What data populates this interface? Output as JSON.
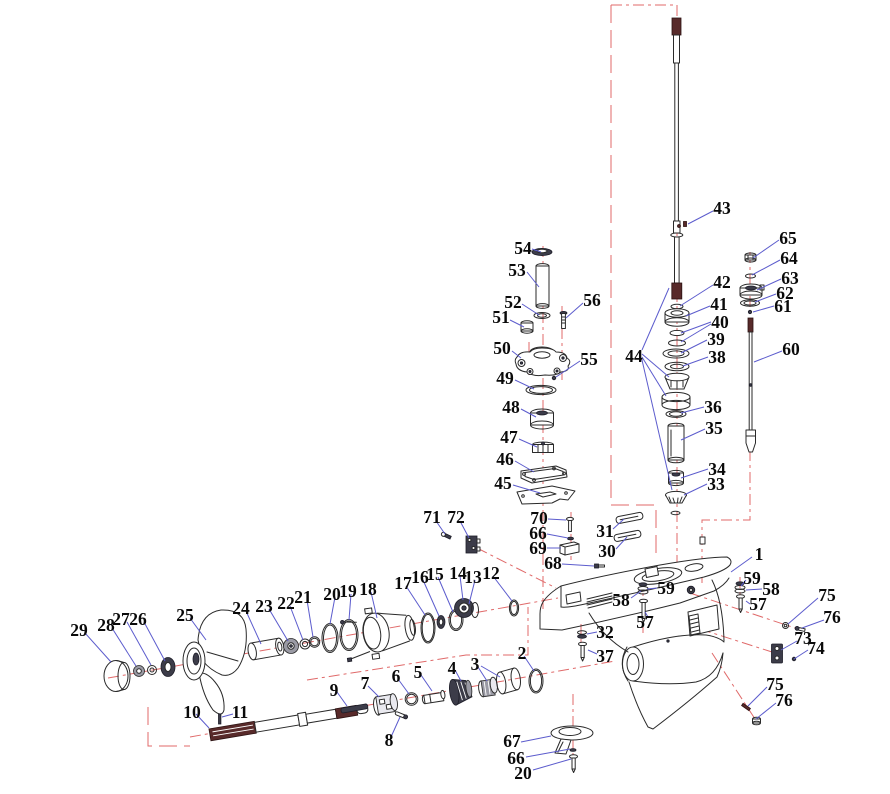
{
  "diagram": {
    "type": "exploded-parts-diagram",
    "subject": "Outboard motor lower unit gearcase exploded view",
    "colors": {
      "background": "#ffffff",
      "outline": "#2a2a2a",
      "leader_line": "#5c5ccd",
      "centerline": "#e06a6a",
      "label_text": "#0a0a0a",
      "dark_part": "#3c3c49",
      "spline_maroon": "#582a2a"
    },
    "labels": [
      {
        "t": "54",
        "x": 523,
        "y": 248
      },
      {
        "t": "53",
        "x": 517,
        "y": 270
      },
      {
        "t": "52",
        "x": 513,
        "y": 302
      },
      {
        "t": "56",
        "x": 592,
        "y": 300
      },
      {
        "t": "51",
        "x": 501,
        "y": 317
      },
      {
        "t": "50",
        "x": 502,
        "y": 348
      },
      {
        "t": "55",
        "x": 589,
        "y": 359
      },
      {
        "t": "49",
        "x": 505,
        "y": 378
      },
      {
        "t": "48",
        "x": 511,
        "y": 407
      },
      {
        "t": "47",
        "x": 509,
        "y": 437
      },
      {
        "t": "46",
        "x": 505,
        "y": 459
      },
      {
        "t": "45",
        "x": 503,
        "y": 483
      },
      {
        "t": "43",
        "x": 722,
        "y": 208
      },
      {
        "t": "42",
        "x": 722,
        "y": 282
      },
      {
        "t": "41",
        "x": 719,
        "y": 304
      },
      {
        "t": "40",
        "x": 720,
        "y": 322
      },
      {
        "t": "39",
        "x": 716,
        "y": 339
      },
      {
        "t": "38",
        "x": 717,
        "y": 357
      },
      {
        "t": "44",
        "x": 634,
        "y": 356
      },
      {
        "t": "36",
        "x": 713,
        "y": 407
      },
      {
        "t": "35",
        "x": 714,
        "y": 428
      },
      {
        "t": "34",
        "x": 717,
        "y": 469
      },
      {
        "t": "33",
        "x": 716,
        "y": 484
      },
      {
        "t": "65",
        "x": 788,
        "y": 238
      },
      {
        "t": "64",
        "x": 789,
        "y": 258
      },
      {
        "t": "63",
        "x": 790,
        "y": 278
      },
      {
        "t": "62",
        "x": 785,
        "y": 293
      },
      {
        "t": "61",
        "x": 783,
        "y": 306
      },
      {
        "t": "60",
        "x": 791,
        "y": 349
      },
      {
        "t": "1",
        "x": 759,
        "y": 554
      },
      {
        "t": "59",
        "x": 666,
        "y": 588
      },
      {
        "t": "58",
        "x": 621,
        "y": 600
      },
      {
        "t": "57",
        "x": 645,
        "y": 622
      },
      {
        "t": "59",
        "x": 752,
        "y": 578
      },
      {
        "t": "58",
        "x": 771,
        "y": 589
      },
      {
        "t": "57",
        "x": 758,
        "y": 604
      },
      {
        "t": "32",
        "x": 605,
        "y": 632
      },
      {
        "t": "37",
        "x": 605,
        "y": 656
      },
      {
        "t": "68",
        "x": 553,
        "y": 563
      },
      {
        "t": "70",
        "x": 539,
        "y": 518
      },
      {
        "t": "66",
        "x": 538,
        "y": 533
      },
      {
        "t": "69",
        "x": 538,
        "y": 548
      },
      {
        "t": "31",
        "x": 605,
        "y": 531
      },
      {
        "t": "30",
        "x": 607,
        "y": 551
      },
      {
        "t": "71",
        "x": 432,
        "y": 517
      },
      {
        "t": "72",
        "x": 456,
        "y": 517
      },
      {
        "t": "75",
        "x": 827,
        "y": 595
      },
      {
        "t": "76",
        "x": 832,
        "y": 617
      },
      {
        "t": "73",
        "x": 803,
        "y": 638
      },
      {
        "t": "74",
        "x": 816,
        "y": 648
      },
      {
        "t": "75",
        "x": 775,
        "y": 684
      },
      {
        "t": "76",
        "x": 784,
        "y": 700
      },
      {
        "t": "67",
        "x": 512,
        "y": 741
      },
      {
        "t": "66",
        "x": 516,
        "y": 758
      },
      {
        "t": "20",
        "x": 523,
        "y": 773
      },
      {
        "t": "29",
        "x": 79,
        "y": 630
      },
      {
        "t": "28",
        "x": 106,
        "y": 625
      },
      {
        "t": "27",
        "x": 121,
        "y": 619
      },
      {
        "t": "26",
        "x": 138,
        "y": 619
      },
      {
        "t": "25",
        "x": 185,
        "y": 615
      },
      {
        "t": "24",
        "x": 241,
        "y": 608
      },
      {
        "t": "23",
        "x": 264,
        "y": 606
      },
      {
        "t": "22",
        "x": 286,
        "y": 603
      },
      {
        "t": "21",
        "x": 303,
        "y": 597
      },
      {
        "t": "20",
        "x": 332,
        "y": 594
      },
      {
        "t": "19",
        "x": 348,
        "y": 591
      },
      {
        "t": "18",
        "x": 368,
        "y": 589
      },
      {
        "t": "17",
        "x": 403,
        "y": 583
      },
      {
        "t": "16",
        "x": 420,
        "y": 577
      },
      {
        "t": "15",
        "x": 435,
        "y": 574
      },
      {
        "t": "14",
        "x": 458,
        "y": 573
      },
      {
        "t": "13",
        "x": 473,
        "y": 577
      },
      {
        "t": "12",
        "x": 491,
        "y": 573
      },
      {
        "t": "2",
        "x": 522,
        "y": 653
      },
      {
        "t": "3",
        "x": 475,
        "y": 664
      },
      {
        "t": "4",
        "x": 452,
        "y": 668
      },
      {
        "t": "5",
        "x": 418,
        "y": 672
      },
      {
        "t": "6",
        "x": 396,
        "y": 676
      },
      {
        "t": "7",
        "x": 365,
        "y": 683
      },
      {
        "t": "8",
        "x": 389,
        "y": 740
      },
      {
        "t": "9",
        "x": 334,
        "y": 690
      },
      {
        "t": "10",
        "x": 192,
        "y": 712
      },
      {
        "t": "11",
        "x": 240,
        "y": 712
      }
    ],
    "leader_lines": [
      [
        532,
        249,
        541,
        252
      ],
      [
        527,
        272,
        539,
        287
      ],
      [
        522,
        304,
        539,
        315
      ],
      [
        583,
        303,
        566,
        318
      ],
      [
        510,
        320,
        524,
        327
      ],
      [
        512,
        351,
        521,
        358
      ],
      [
        580,
        361,
        556,
        377
      ],
      [
        515,
        380,
        534,
        389
      ],
      [
        521,
        409,
        536,
        417
      ],
      [
        519,
        439,
        537,
        447
      ],
      [
        515,
        461,
        534,
        472
      ],
      [
        513,
        485,
        540,
        493
      ],
      [
        713,
        211,
        688,
        224
      ],
      [
        713,
        285,
        680,
        306
      ],
      [
        710,
        306,
        686,
        316
      ],
      [
        711,
        322,
        681,
        333
      ],
      [
        711,
        324,
        681,
        342
      ],
      [
        707,
        340,
        681,
        353
      ],
      [
        708,
        357,
        683,
        366
      ],
      [
        642,
        350,
        669,
        288
      ],
      [
        642,
        354,
        669,
        377
      ],
      [
        642,
        357,
        666,
        396
      ],
      [
        642,
        360,
        672,
        490
      ],
      [
        704,
        407,
        681,
        413
      ],
      [
        705,
        429,
        681,
        440
      ],
      [
        708,
        469,
        681,
        478
      ],
      [
        707,
        484,
        684,
        495
      ],
      [
        779,
        240,
        753,
        258
      ],
      [
        780,
        260,
        752,
        275
      ],
      [
        781,
        279,
        757,
        290
      ],
      [
        776,
        294,
        755,
        302
      ],
      [
        774,
        306,
        753,
        312
      ],
      [
        782,
        351,
        754,
        362
      ],
      [
        752,
        557,
        731,
        572
      ],
      [
        657,
        588,
        647,
        589
      ],
      [
        631,
        598,
        641,
        591
      ],
      [
        648,
        617,
        645,
        612
      ],
      [
        746,
        580,
        741,
        586
      ],
      [
        762,
        589,
        746,
        590
      ],
      [
        750,
        604,
        746,
        601
      ],
      [
        597,
        632,
        587,
        634
      ],
      [
        597,
        654,
        588,
        650
      ],
      [
        562,
        564,
        594,
        566
      ],
      [
        548,
        519,
        566,
        520
      ],
      [
        547,
        534,
        568,
        538
      ],
      [
        547,
        548,
        561,
        548
      ],
      [
        613,
        529,
        624,
        519
      ],
      [
        616,
        549,
        627,
        537
      ],
      [
        436,
        521,
        445,
        534
      ],
      [
        460,
        521,
        469,
        538
      ],
      [
        818,
        598,
        788,
        624
      ],
      [
        824,
        620,
        802,
        628
      ],
      [
        797,
        641,
        781,
        650
      ],
      [
        808,
        650,
        794,
        659
      ],
      [
        767,
        687,
        748,
        706
      ],
      [
        776,
        703,
        756,
        719
      ],
      [
        521,
        742,
        551,
        736
      ],
      [
        526,
        757,
        570,
        749
      ],
      [
        533,
        770,
        571,
        759
      ],
      [
        85,
        633,
        111,
        662
      ],
      [
        112,
        628,
        136,
        666
      ],
      [
        127,
        622,
        151,
        665
      ],
      [
        144,
        622,
        165,
        661
      ],
      [
        190,
        618,
        206,
        640
      ],
      [
        246,
        611,
        261,
        644
      ],
      [
        269,
        609,
        288,
        641
      ],
      [
        290,
        606,
        303,
        640
      ],
      [
        307,
        600,
        313,
        637
      ],
      [
        335,
        597,
        330,
        624
      ],
      [
        351,
        594,
        349,
        620
      ],
      [
        371,
        592,
        377,
        618
      ],
      [
        406,
        586,
        425,
        615
      ],
      [
        423,
        580,
        439,
        616
      ],
      [
        438,
        577,
        453,
        612
      ],
      [
        460,
        576,
        463,
        600
      ],
      [
        475,
        580,
        469,
        604
      ],
      [
        493,
        576,
        512,
        601
      ],
      [
        524,
        656,
        534,
        671
      ],
      [
        478,
        667,
        487,
        681
      ],
      [
        481,
        666,
        500,
        677
      ],
      [
        455,
        670,
        461,
        681
      ],
      [
        421,
        675,
        432,
        691
      ],
      [
        398,
        679,
        409,
        694
      ],
      [
        368,
        686,
        379,
        697
      ],
      [
        391,
        737,
        400,
        717
      ],
      [
        337,
        692,
        347,
        706
      ],
      [
        196,
        714,
        209,
        728
      ],
      [
        233,
        714,
        222,
        717
      ]
    ]
  }
}
